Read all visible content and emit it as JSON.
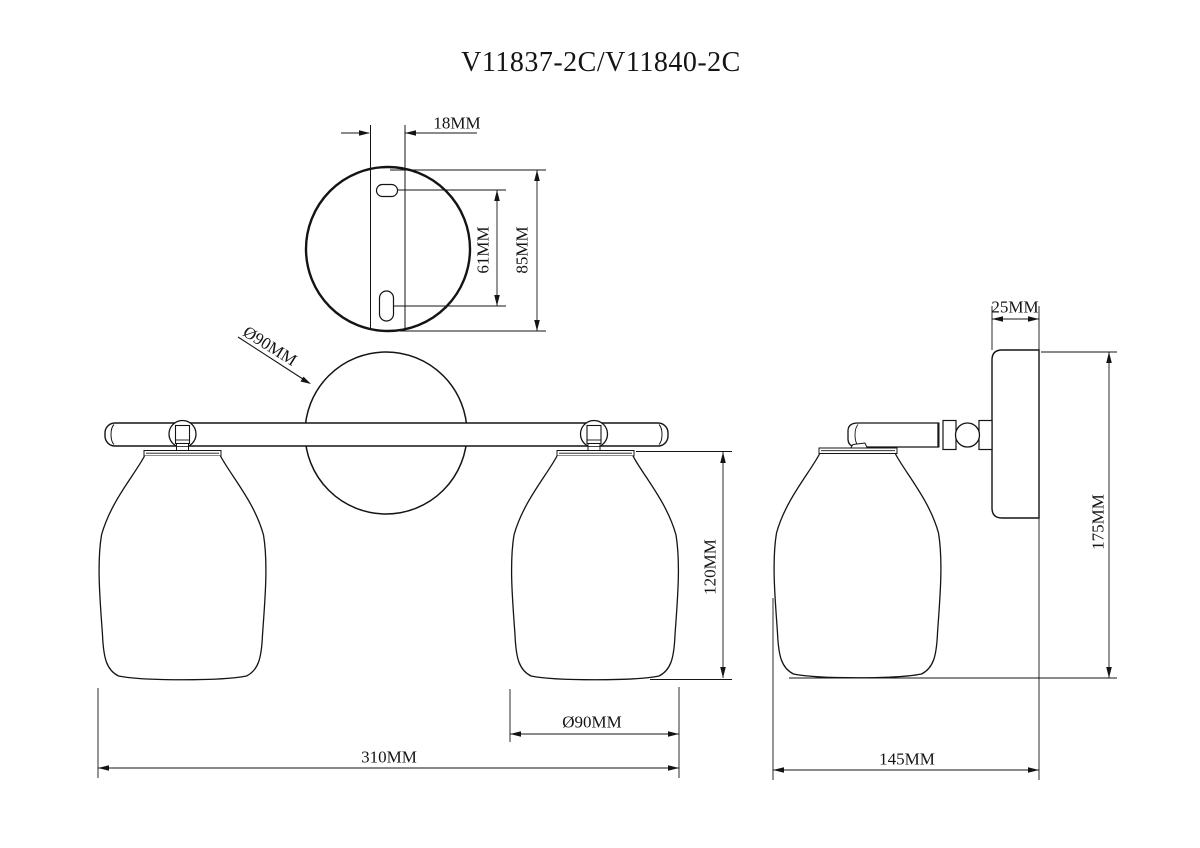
{
  "title": "V11837-2C/V11840-2C",
  "views": {
    "top_view": {
      "dimensions": {
        "slot_offset": "18MM",
        "hole_spacing": "61MM",
        "plate_diameter": "85MM"
      }
    },
    "front_view": {
      "dimensions": {
        "backplate_diameter": "Ø90MM",
        "shade_height": "120MM",
        "shade_diameter": "Ø90MM",
        "overall_width": "310MM"
      }
    },
    "side_view": {
      "dimensions": {
        "backplate_depth": "25MM",
        "overall_height": "175MM",
        "overall_depth": "145MM"
      }
    }
  }
}
